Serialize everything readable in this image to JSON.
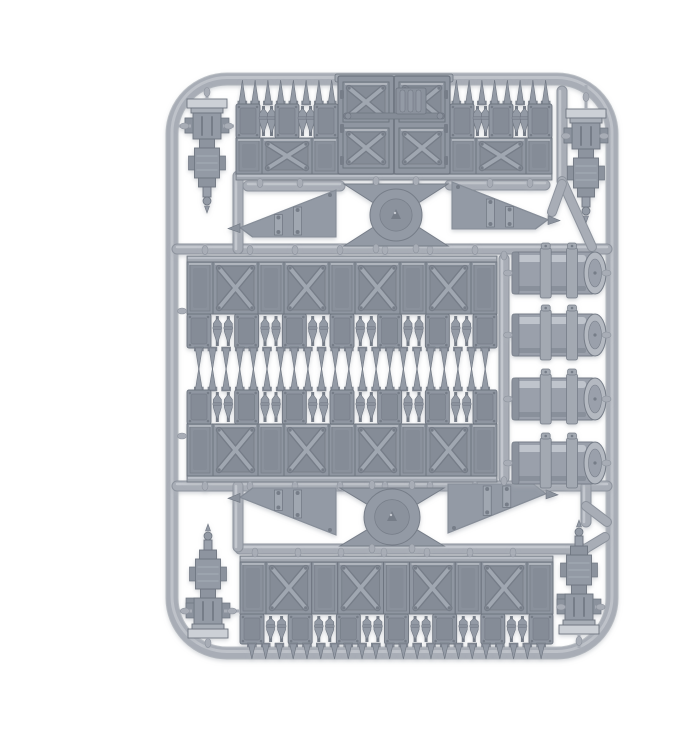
{
  "meta": {
    "subject": "Grey polystyrene model kit sprue of gothic fortification wall terrain parts photographed on a white background",
    "background": "#ffffff"
  },
  "palette": {
    "runner": "#a8adb6",
    "runner_hi": "#c3c7ce",
    "runner_dk": "#8d939d",
    "part": "#939aa5",
    "part_hi": "#c6cad1",
    "part_md": "#8b929d",
    "part_dk": "#767d88",
    "line": "#6e7580",
    "panel": "#8f96a1",
    "panel_in": "#858c97",
    "panel_in2": "#8a919c",
    "brace": "#a0a7b1",
    "cap_light": "#ccd0d6",
    "bar": "#a2a8b1",
    "barrel_body": "#9aa0ab",
    "barrel_cap": "#b4b9c1",
    "shadow": "#aeb3ba"
  },
  "frame": {
    "x": 132,
    "y": 63,
    "w": 440,
    "h": 574,
    "r": 55,
    "t": 11
  },
  "runners": {
    "h": [
      [
        137,
        567,
        233
      ],
      [
        137,
        567,
        470
      ],
      [
        200,
        545,
        533
      ],
      [
        208,
        300,
        170
      ],
      [
        410,
        505,
        169
      ]
    ],
    "v": [
      [
        198,
        160,
        233
      ],
      [
        198,
        470,
        531
      ],
      [
        464,
        243,
        462
      ],
      [
        522,
        75,
        165
      ],
      [
        546,
        470,
        506
      ]
    ],
    "d": [
      [
        522,
        165,
        552,
        231
      ],
      [
        546,
        490,
        567,
        506
      ],
      [
        545,
        533,
        565,
        521
      ],
      [
        512,
        196,
        522,
        168
      ]
    ]
  },
  "top_wall": {
    "x": 196,
    "w": 316,
    "wing_w": 102,
    "spike_tip_y": 64,
    "spike_base_y": 88,
    "wing_spikes": 8,
    "small_row": {
      "y": 88,
      "h": 34,
      "panels": 3
    },
    "big_row": {
      "y": 122,
      "h": 36,
      "x_panels": 1
    },
    "gate": {
      "x": 298,
      "w": 112,
      "y": 60,
      "h": 98,
      "latch_y": 97
    },
    "bottom_bar_y": 158
  },
  "mid_wall_1": {
    "x": 147,
    "w": 310,
    "bar_y": 240,
    "big_y": 246,
    "big_h": 52,
    "small_y": 298,
    "small_h": 34,
    "small_panels": 7,
    "spike_base_y": 332,
    "spike_len": 22,
    "spikes": 22,
    "x_panels": 4
  },
  "mid_wall_2": {
    "x": 147,
    "w": 310,
    "spike_base_y": 374,
    "spike_len": 22,
    "spikes": 22,
    "small_y": 374,
    "small_h": 34,
    "small_panels": 7,
    "big_y": 408,
    "big_h": 52,
    "bar_y": 460,
    "x_panels": 4
  },
  "bottom_wall": {
    "x": 200,
    "w": 313,
    "bar_y": 540,
    "big_y": 546,
    "big_h": 52,
    "small_y": 598,
    "small_h": 30,
    "small_panels": 7,
    "spike_base_y": 628,
    "spike_len": 15,
    "spikes": 22,
    "x_panels": 4
  },
  "junctions": [
    {
      "cx": 356,
      "top": 168,
      "bottom": 230,
      "disc_r": 26,
      "top_w": 104,
      "waist_w": 46
    },
    {
      "cx": 352,
      "top": 472,
      "bottom": 530,
      "disc_r": 28,
      "top_w": 104,
      "waist_w": 46
    }
  ],
  "buttresses": [
    {
      "x": 200,
      "y": 174,
      "w": 96,
      "h": 47,
      "tip": "left",
      "slope": "top"
    },
    {
      "x": 412,
      "y": 166,
      "w": 96,
      "h": 47,
      "tip": "right",
      "slope": "top"
    },
    {
      "x": 200,
      "y": 472,
      "w": 96,
      "h": 47,
      "tip": "left",
      "slope": "bottom"
    },
    {
      "x": 408,
      "y": 468,
      "w": 98,
      "h": 49,
      "tip": "right",
      "slope": "bottom"
    }
  ],
  "pillars": [
    {
      "cx": 167,
      "cap_y": 83,
      "flip": false,
      "twig_left_to": 138,
      "twig_right_to": 194
    },
    {
      "cx": 546,
      "cap_y": 93,
      "flip": false,
      "twig_left_to": 522,
      "twig_right_to": 566
    },
    {
      "cx": 168,
      "cap_y": 622,
      "flip": true,
      "twig_left_to": 138,
      "twig_right_to": 200
    },
    {
      "cx": 539,
      "cap_y": 618,
      "flip": true,
      "twig_left_to": 519,
      "twig_right_to": 566
    }
  ],
  "barrels": {
    "x": 472,
    "w": 94,
    "h": 46,
    "centers_y": [
      257,
      319,
      383,
      447
    ]
  },
  "inventory": [
    {
      "part": "sprue-frame",
      "qty": 1
    },
    {
      "part": "gate-wall-section-with-double-doors",
      "qty": 1
    },
    {
      "part": "spiked-wall-section",
      "qty": 4
    },
    {
      "part": "corner-pillar-post",
      "qty": 4
    },
    {
      "part": "support-buttress",
      "qty": 4
    },
    {
      "part": "round-junction-base",
      "qty": 2
    },
    {
      "part": "storage-drum",
      "qty": 4
    }
  ]
}
